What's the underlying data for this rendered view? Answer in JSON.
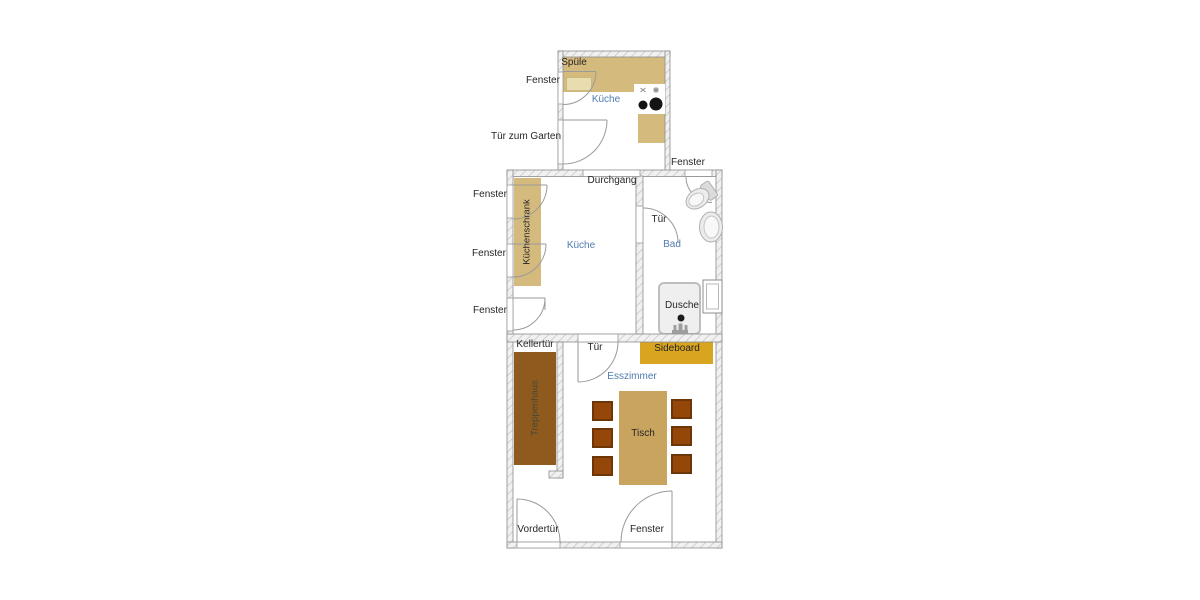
{
  "colors": {
    "label_blue": "#4f7cb0",
    "counter_tan": "#d5ba7e",
    "table_tan": "#c9a45f",
    "sideboard_gold": "#d9a521",
    "stairs_brown": "#8f5a1e",
    "chair_brown": "#944708",
    "chair_border": "#6e3606",
    "shower_gray": "#efefef"
  },
  "labels": {
    "top_kitchen": {
      "room": "Küche",
      "sink": "Spüle",
      "window": "Fenster",
      "garden_door": "Tür zum Garten"
    },
    "main_kitchen": {
      "room": "Küche",
      "cabinet": "Küchenschrank",
      "passage": "Durchgang",
      "window_1": "Fenster",
      "window_2": "Fenster",
      "window_3": "Fenster"
    },
    "bathroom": {
      "room": "Bad",
      "door": "Tür",
      "shower": "Dusche",
      "window": "Fenster"
    },
    "dining": {
      "room": "Esszimmer",
      "table": "Tisch",
      "sideboard": "Sideboard",
      "stairs": "Treppenhaus",
      "cellar_door": "Kellertür",
      "door": "Tür",
      "front_door": "Vordertür",
      "window": "Fenster"
    }
  }
}
